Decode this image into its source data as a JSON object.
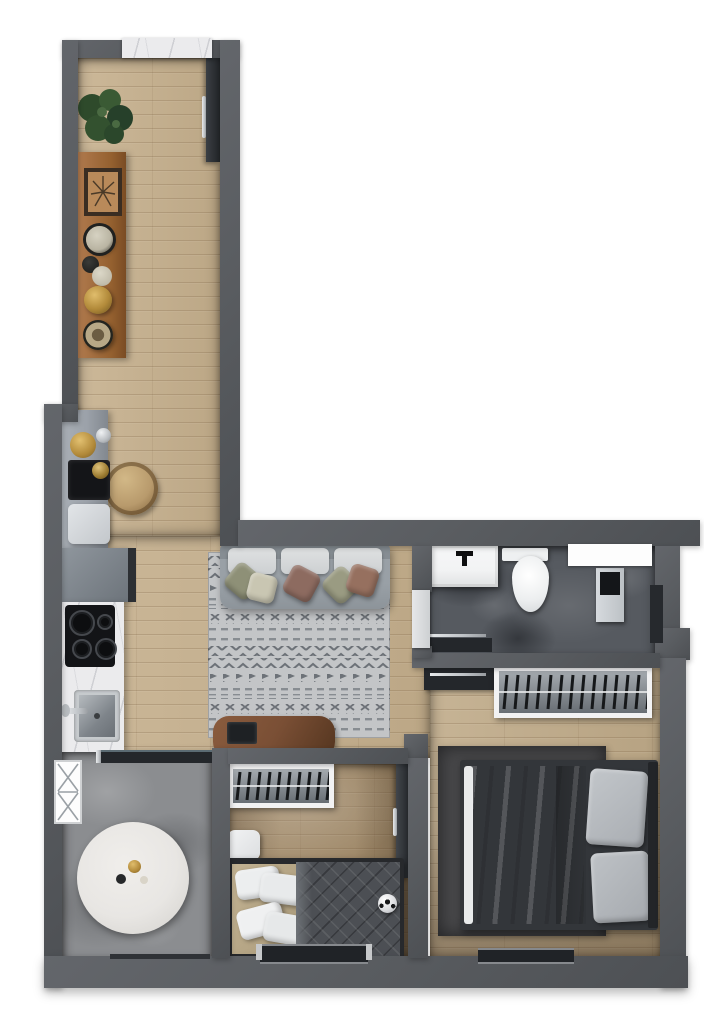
{
  "meta": {
    "kind": "apartment floor plan render",
    "view": "top-down",
    "units": "none-visible",
    "text_labels": []
  },
  "colors": {
    "background": "#ffffff",
    "wall": "#5a5d61",
    "wood_floor": "#c6b08d",
    "wood_floor_master": "#c0ab89",
    "wood_floor_dark": "#a28a68",
    "stone_floor": "#565a60",
    "concrete_floor": "#8b8d90",
    "marble": "#ebebed",
    "counter_gray": "#9ba1a9",
    "rug_base": "#c3c5c7",
    "rug_pattern": "#6d7278",
    "rug_master": "#474749",
    "sofa": "#99a0a6",
    "cushion": "#d6d8da",
    "pillow_olive": "#8e9077",
    "pillow_mauve": "#8d6b60",
    "pillow_cream": "#c9c6b2",
    "duvet_gray": "#a3a7ab",
    "duvet_dark": "#4c4f54",
    "furniture_dark": "#232528",
    "door_dark": "#2d3135",
    "chrome": "#c0c4c8",
    "brass": "#b28a3a",
    "wood_furniture": "#7a4f35",
    "plant_green": "#2e4a2b",
    "white_fixture": "#f2f3f4",
    "glass_dark": "#24272b",
    "basket_tan": "#b89a6c",
    "table_marble": "#e8e6e3",
    "chair_black": "#26282c",
    "plate_teal": "#338a8a",
    "plate_red": "#b54a3a",
    "plate_gold": "#c9a23a"
  },
  "rooms": [
    {
      "name": "kitchen-hallway",
      "floor": "wood-plank"
    },
    {
      "name": "living-room",
      "floor": "wood-plank"
    },
    {
      "name": "bathroom",
      "floor": "dark-stone"
    },
    {
      "name": "dining-area",
      "floor": "concrete"
    },
    {
      "name": "primary-bedroom",
      "floor": "wood-plank"
    },
    {
      "name": "second-bedroom",
      "floor": "dark-wood-plank"
    }
  ],
  "furniture": [
    "entry-door",
    "marble-window-sill",
    "potted-plant",
    "wood-sideboard",
    "decor-plates",
    "brass-kettle",
    "round-woven-basket",
    "kitchen-counter",
    "refrigerator",
    "induction-cooktop",
    "kitchen-sink",
    "sliding-glass-door",
    "sofa",
    "throw-pillows",
    "patterned-area-rug",
    "wood-console-desk",
    "laptop",
    "bathroom-vanity",
    "toilet",
    "bathroom-window",
    "shower-column",
    "glass-shower-door",
    "wardrobe-with-hangers",
    "double-bed",
    "bed-pillows",
    "nightstand",
    "dark-rug",
    "bedroom-window",
    "single-bed",
    "white-nightstand",
    "soccer-ball",
    "bedroom-door",
    "left-window",
    "round-dining-table",
    "place-settings",
    "dining-chairs"
  ]
}
